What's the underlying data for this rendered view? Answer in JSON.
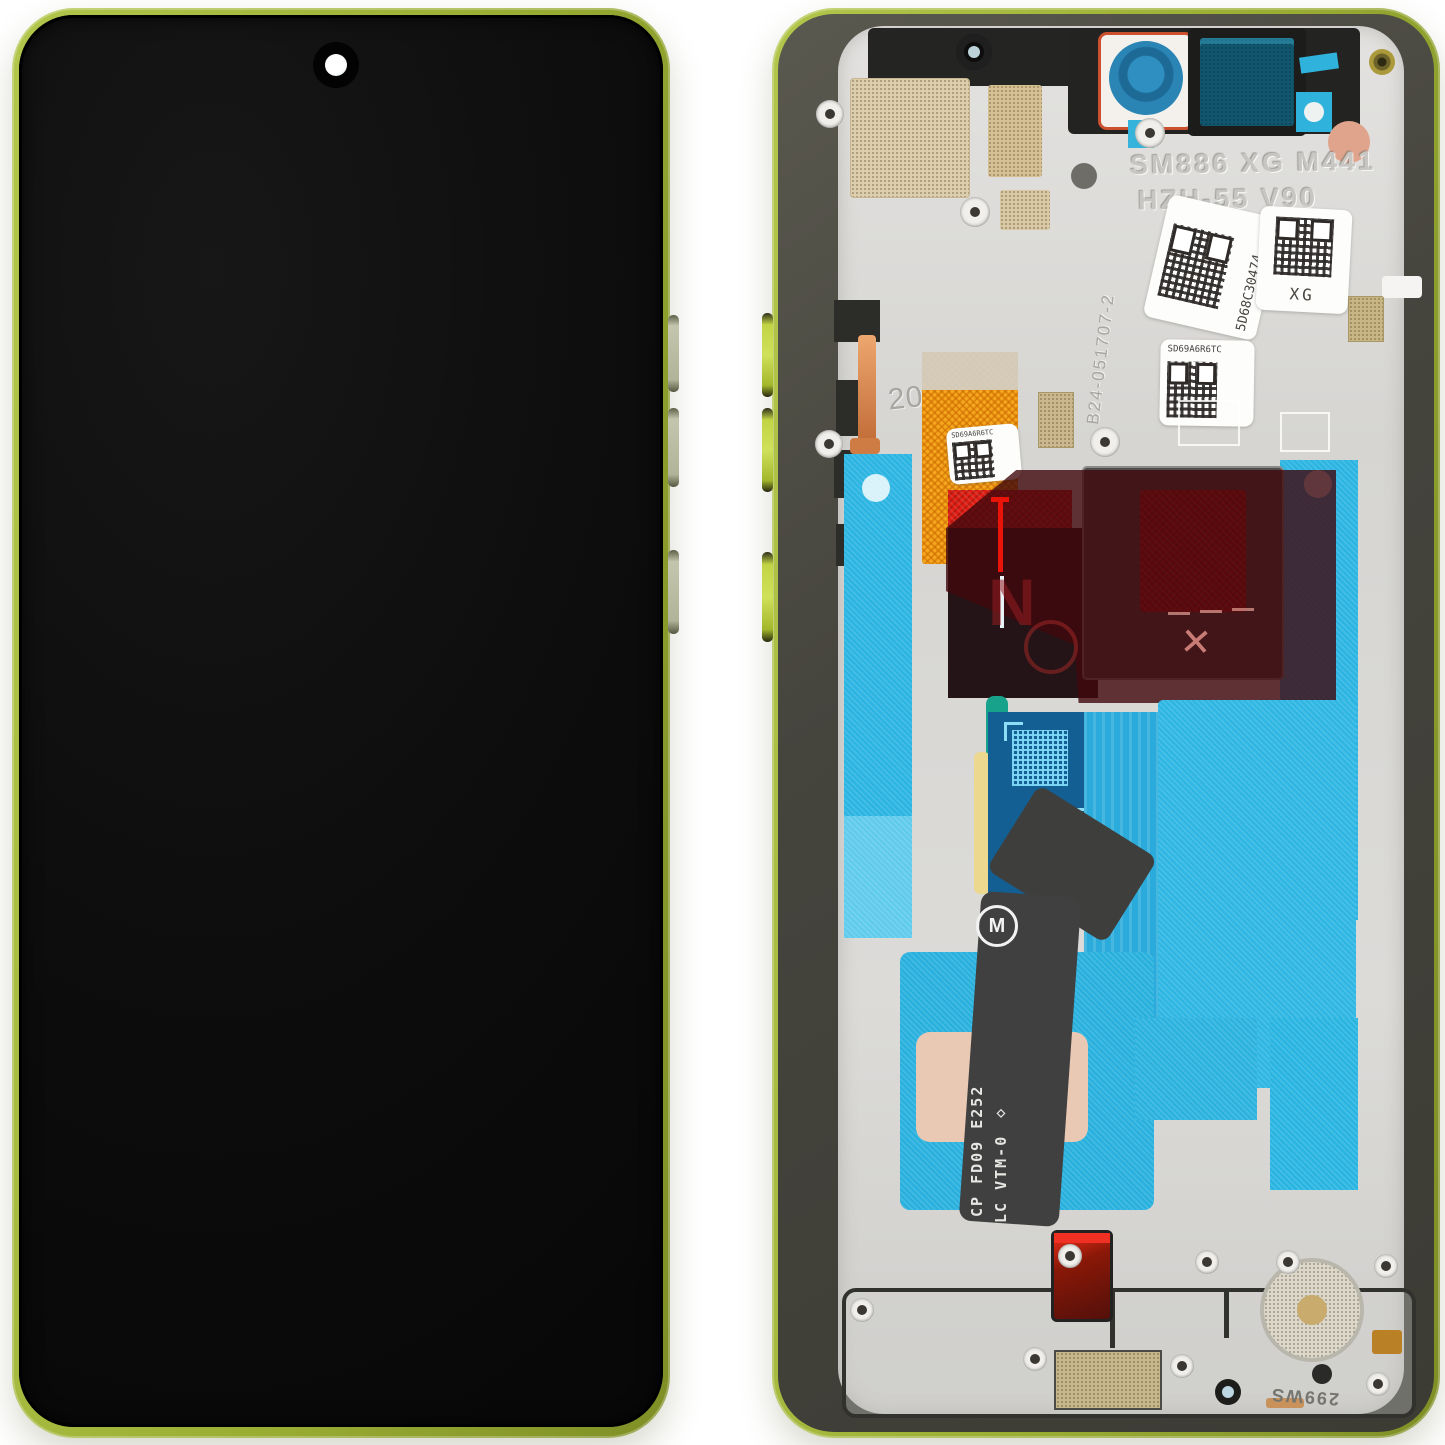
{
  "product": {
    "title": "Phone display assembly, front and back view",
    "front": {
      "frame_color": "#a9bd3e",
      "screen_color": "#0e0e0e"
    },
    "back": {
      "etched": {
        "model_line1": "SM886 XG M441",
        "model_line2": "HZH-55 V90",
        "serial_vertical": "B24-051707-2",
        "year": "2025",
        "bottom_code": "299WS"
      },
      "labels": {
        "qr_label_1": "5D68C30474",
        "qr_label_2": "XG",
        "qr_label_3": "SD69A6R6TC",
        "flex_label": "SD69A6R6TC"
      },
      "flex_print": {
        "line1": "CP FD09 E252",
        "line2": "LC VTM-0 ◇"
      },
      "marks": {
        "x_mark": "✕",
        "n_mark": "N",
        "logo_letter": "M"
      },
      "colors": {
        "adhesive_cyan": "#29b4e1",
        "flex_orange": "#f5a81d",
        "warning_red": "#c9130e",
        "pad_pink": "#eac9b4",
        "lens_blue": "#2a85b5",
        "frame_green": "#a9bd3e"
      }
    }
  }
}
